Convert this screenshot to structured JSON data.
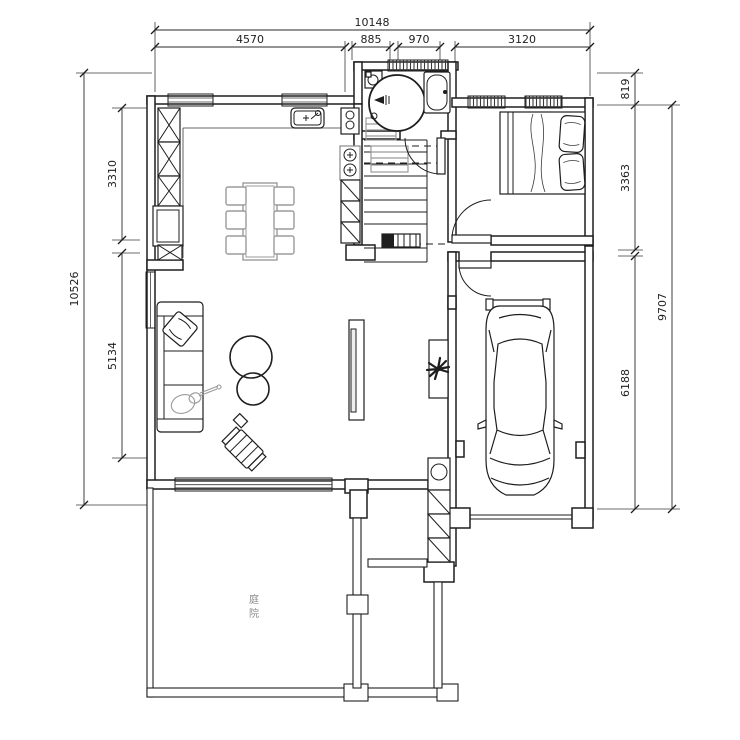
{
  "dimensions": {
    "top": {
      "total": "10148",
      "segments": [
        "4570",
        "885",
        "970",
        "3120"
      ]
    },
    "left": {
      "total": "10526",
      "segments": [
        "3310",
        "5134"
      ]
    },
    "right": {
      "total_outer": "9707",
      "segments": [
        "819",
        "3363",
        "6188"
      ]
    }
  },
  "labels": {
    "courtyard": "庭院",
    "courtyard_chars": [
      "庭",
      "院"
    ]
  },
  "colors": {
    "ink": "#1e1e1e",
    "furniture_gray": "#9b9b9b",
    "dim_text": "#2a2a2a",
    "background": "#ffffff"
  }
}
